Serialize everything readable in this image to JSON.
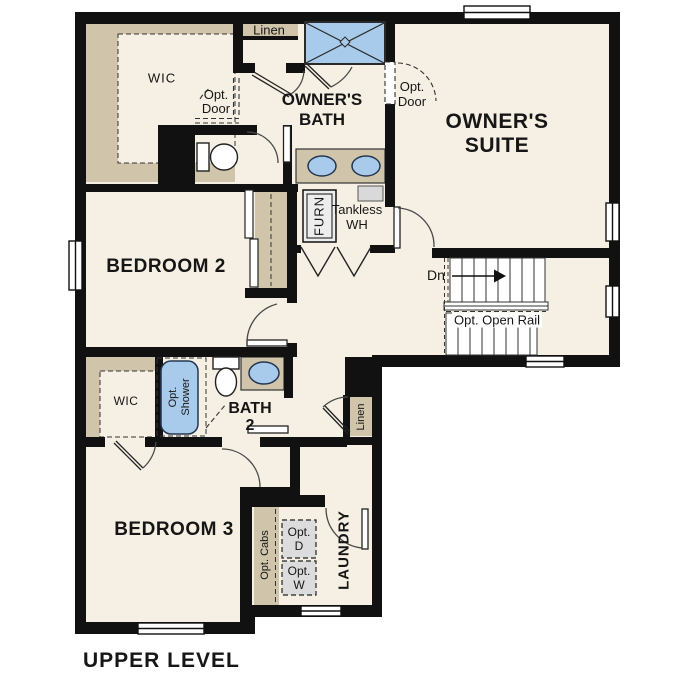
{
  "title": "UPPER LEVEL",
  "rooms": {
    "owners_suite_1": "OWNER'S",
    "owners_suite_2": "SUITE",
    "owners_bath_1": "OWNER'S",
    "owners_bath_2": "BATH",
    "bedroom2": "BEDROOM 2",
    "bedroom3": "BEDROOM 3",
    "bath2_1": "BATH",
    "bath2_2": "2",
    "laundry": "LAUNDRY",
    "wic_upper": "WIC",
    "wic_lower": "WIC",
    "linen_upper": "Linen",
    "linen_lower": "Linen"
  },
  "annotations": {
    "opt_door_1": "Opt.",
    "opt_door_2": "Door",
    "furnace": "FURN",
    "tankless_1": "Tankless",
    "tankless_2": "WH",
    "stairs_down": "Dn",
    "opt_open_rail": "Opt. Open Rail",
    "opt_shower_1": "Opt.",
    "opt_shower_2": "Shower",
    "opt_cabs": "Opt. Cabs",
    "opt_dryer_1": "Opt.",
    "opt_dryer_2": "D",
    "opt_washer_1": "Opt.",
    "opt_washer_2": "W"
  },
  "colors": {
    "floor": "#F6EFE3",
    "casework": "#D0C5AB",
    "fixture_blue": "#A9CBEB",
    "wall": "#111111",
    "appliance_gray": "#DCDCDC"
  }
}
